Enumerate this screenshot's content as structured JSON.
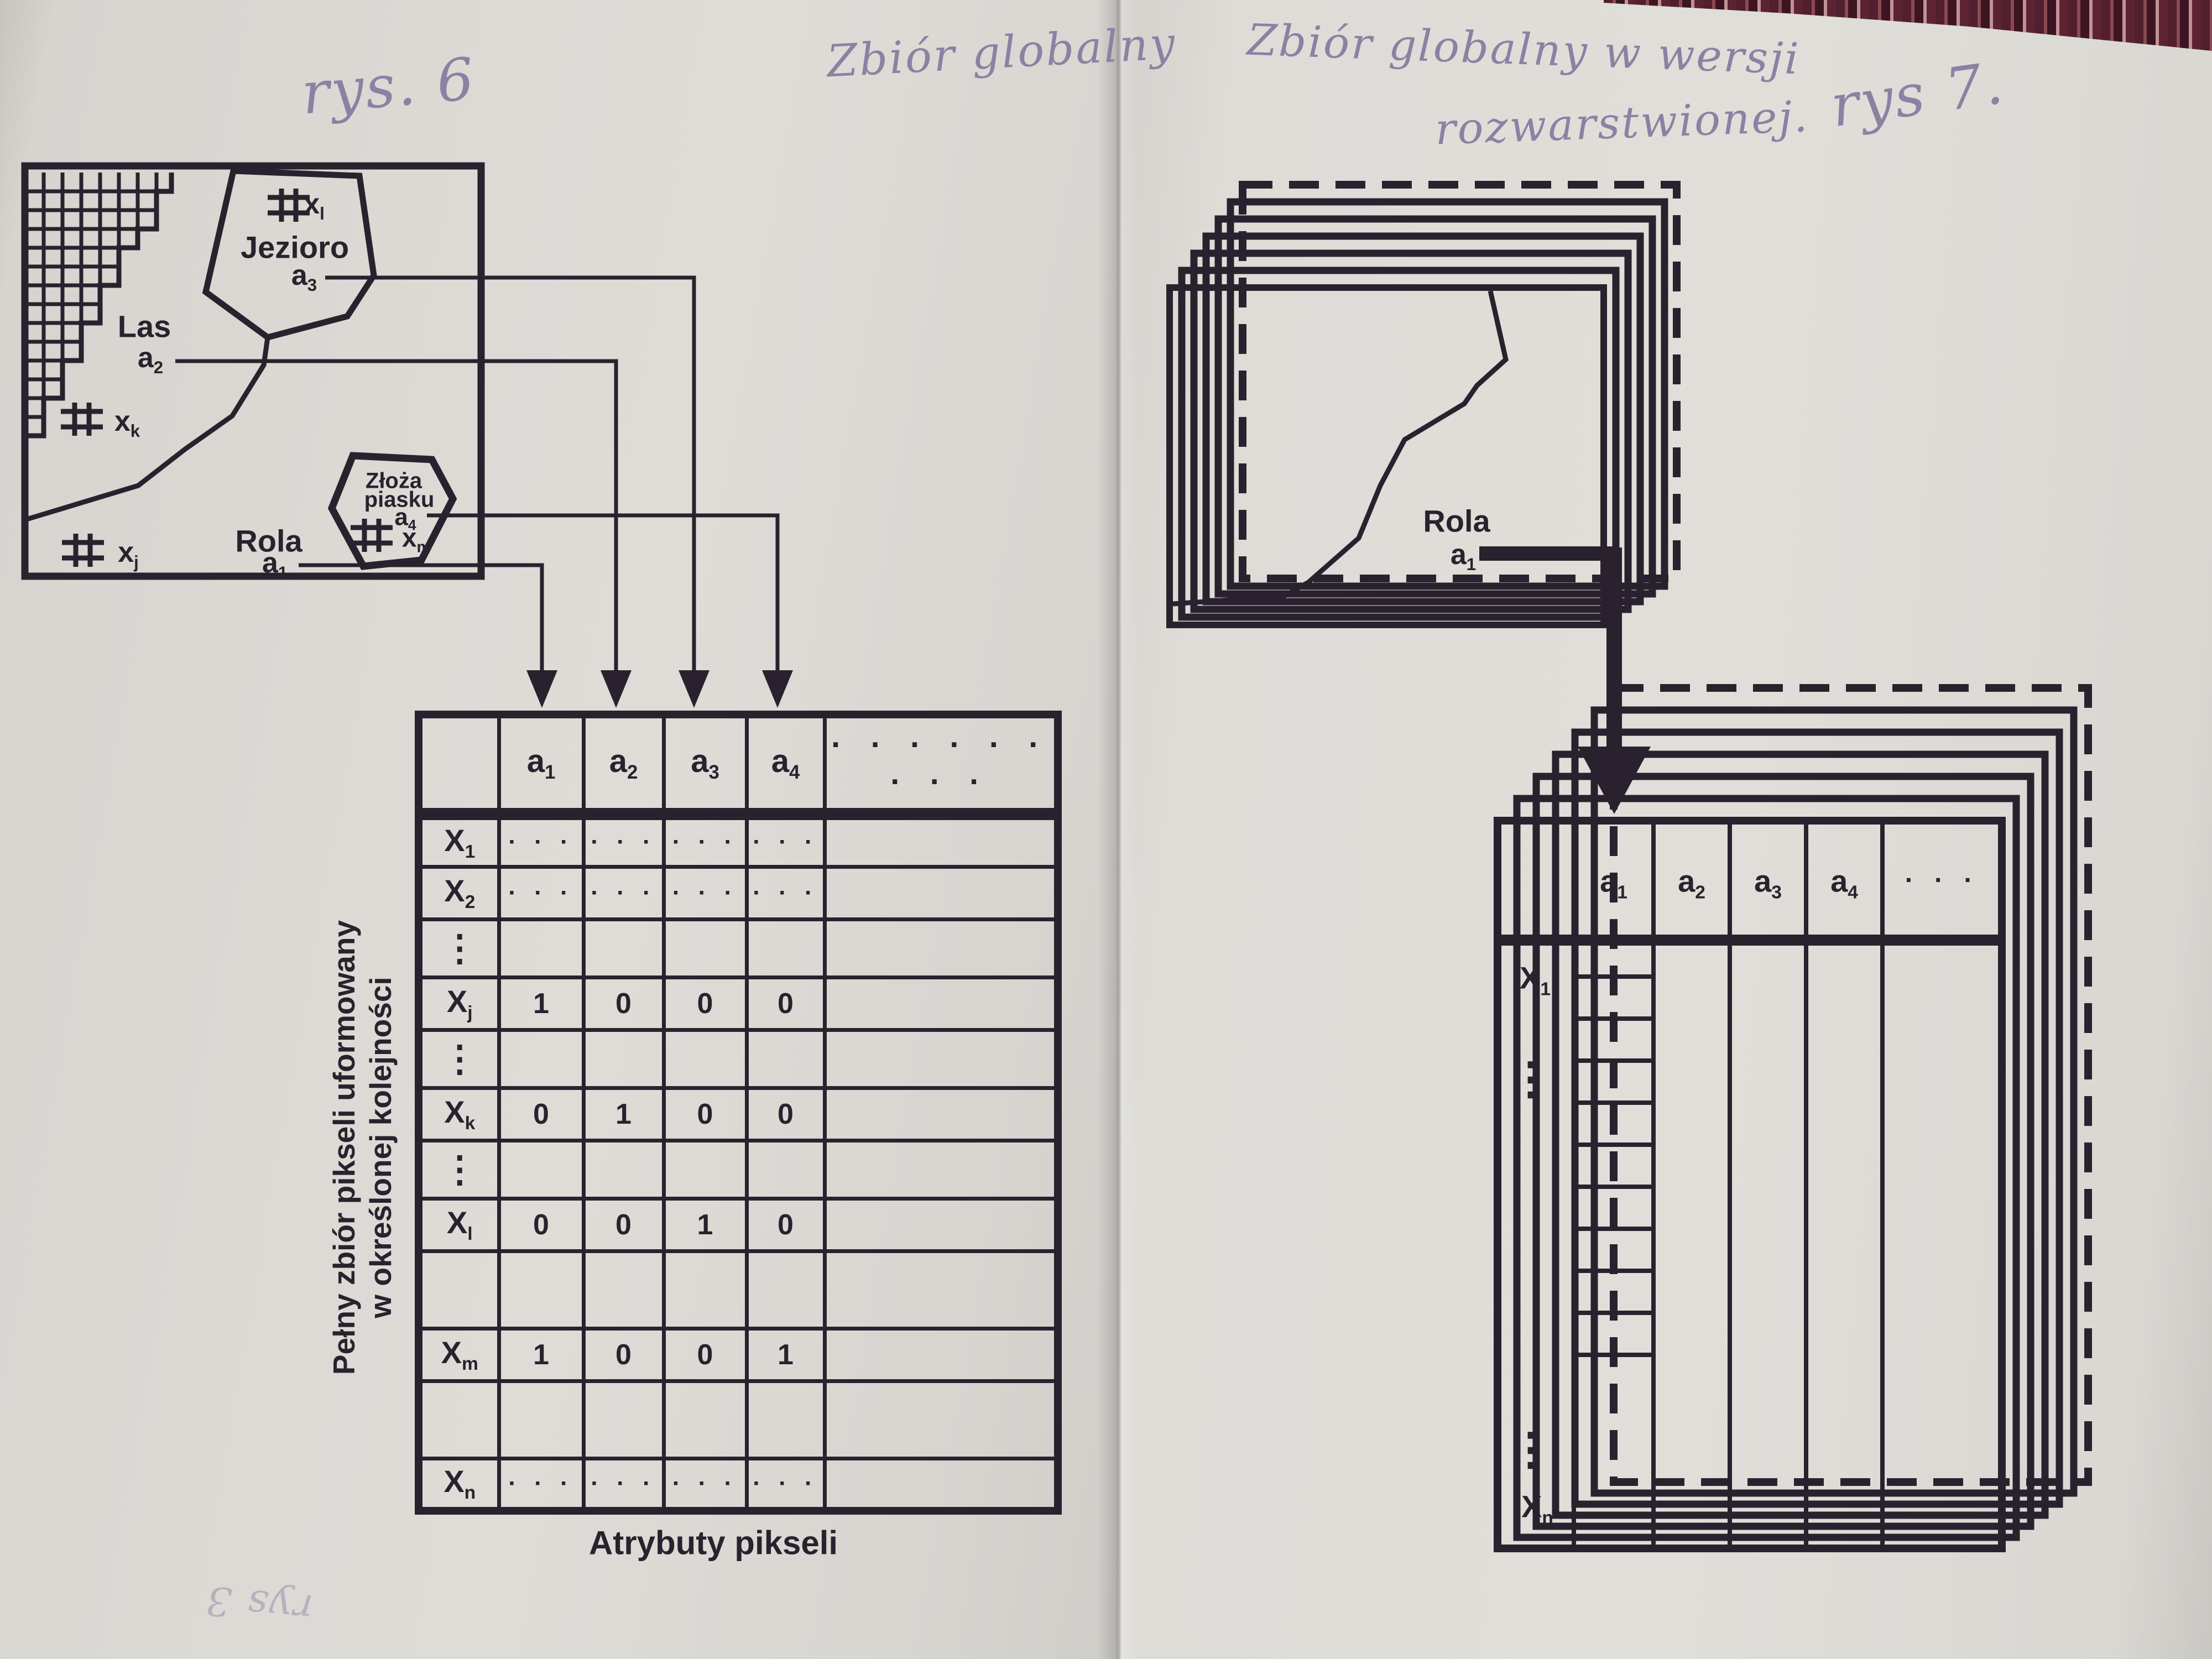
{
  "colors": {
    "ink": "#29222e",
    "paper_left": "#dbd9d4",
    "paper_right": "#dedcd7",
    "pencil": "#8c81a3",
    "fabric_dark": "#511f2e",
    "fabric_light": "#c09298"
  },
  "page_left": {
    "fig_hw": "rys. 6",
    "heading_hw": "Zbiór globalny",
    "map": {
      "regions": [
        {
          "name": "Jezioro",
          "attr": {
            "base": "a",
            "sub": "3"
          }
        },
        {
          "name": "Las",
          "attr": {
            "base": "a",
            "sub": "2"
          }
        },
        {
          "name": "Złoża",
          "name2": "piasku",
          "attr": {
            "base": "a",
            "sub": "4"
          }
        },
        {
          "name": "Rola",
          "attr": {
            "base": "a",
            "sub": "1"
          }
        }
      ],
      "markers": [
        {
          "base": "x",
          "sub": "l"
        },
        {
          "base": "x",
          "sub": "k"
        },
        {
          "base": "x",
          "sub": "j"
        },
        {
          "base": "x",
          "sub": "m"
        }
      ]
    },
    "side_label": {
      "line1": "Pełny zbiór pikseli uformowany",
      "line2": "w określonej kolejności"
    },
    "table": {
      "corner": "",
      "col_headers": [
        {
          "base": "a",
          "sub": "1"
        },
        {
          "base": "a",
          "sub": "2"
        },
        {
          "base": "a",
          "sub": "3"
        },
        {
          "base": "a",
          "sub": "4"
        }
      ],
      "header_dots": "· · · · · · · · ·",
      "rows": [
        {
          "label": {
            "base": "X",
            "sub": "1"
          },
          "cells": [
            "· · ·",
            "· · ·",
            "· · ·",
            "· · ·",
            ""
          ]
        },
        {
          "label": {
            "base": "X",
            "sub": "2"
          },
          "cells": [
            "· · ·",
            "· · ·",
            "· · ·",
            "· · ·",
            ""
          ]
        },
        {
          "label": {
            "base": "⋮",
            "sub": ""
          },
          "cells": [
            "",
            "",
            "",
            "",
            ""
          ]
        },
        {
          "label": {
            "base": "X",
            "sub": "j"
          },
          "cells": [
            "1",
            "0",
            "0",
            "0",
            ""
          ]
        },
        {
          "label": {
            "base": "⋮",
            "sub": ""
          },
          "cells": [
            "",
            "",
            "",
            "",
            ""
          ]
        },
        {
          "label": {
            "base": "X",
            "sub": "k"
          },
          "cells": [
            "0",
            "1",
            "0",
            "0",
            ""
          ]
        },
        {
          "label": {
            "base": "⋮",
            "sub": ""
          },
          "cells": [
            "",
            "",
            "",
            "",
            ""
          ]
        },
        {
          "label": {
            "base": "X",
            "sub": "l"
          },
          "cells": [
            "0",
            "0",
            "1",
            "0",
            ""
          ]
        },
        {
          "label": {
            "base": "",
            "sub": ""
          },
          "cells": [
            "",
            "",
            "",
            "",
            ""
          ]
        },
        {
          "label": {
            "base": "X",
            "sub": "m"
          },
          "cells": [
            "1",
            "0",
            "0",
            "1",
            ""
          ]
        },
        {
          "label": {
            "base": "",
            "sub": ""
          },
          "cells": [
            "",
            "",
            "",
            "",
            ""
          ]
        },
        {
          "label": {
            "base": "X",
            "sub": "n"
          },
          "cells": [
            "· · ·",
            "· · ·",
            "· · ·",
            "· · ·",
            ""
          ]
        }
      ]
    },
    "caption": "Atrybuty pikseli",
    "corner_scribble": "rys 3"
  },
  "page_right": {
    "heading_hw1": "Zbiór globalny w wersji",
    "heading_hw2": "rozwarstwionej.",
    "fig_hw": "rys 7.",
    "stack": {
      "region": "Rola",
      "attr": {
        "base": "a",
        "sub": "1"
      }
    },
    "table": {
      "col_headers": [
        {
          "base": "a",
          "sub": "1"
        },
        {
          "base": "a",
          "sub": "2"
        },
        {
          "base": "a",
          "sub": "3"
        },
        {
          "base": "a",
          "sub": "4"
        }
      ],
      "header_dots": "· · ·",
      "top_label": {
        "base": "X",
        "sub": "1"
      },
      "vdots": "⋮",
      "bottom_label": {
        "base": "X",
        "sub": "n"
      }
    }
  }
}
